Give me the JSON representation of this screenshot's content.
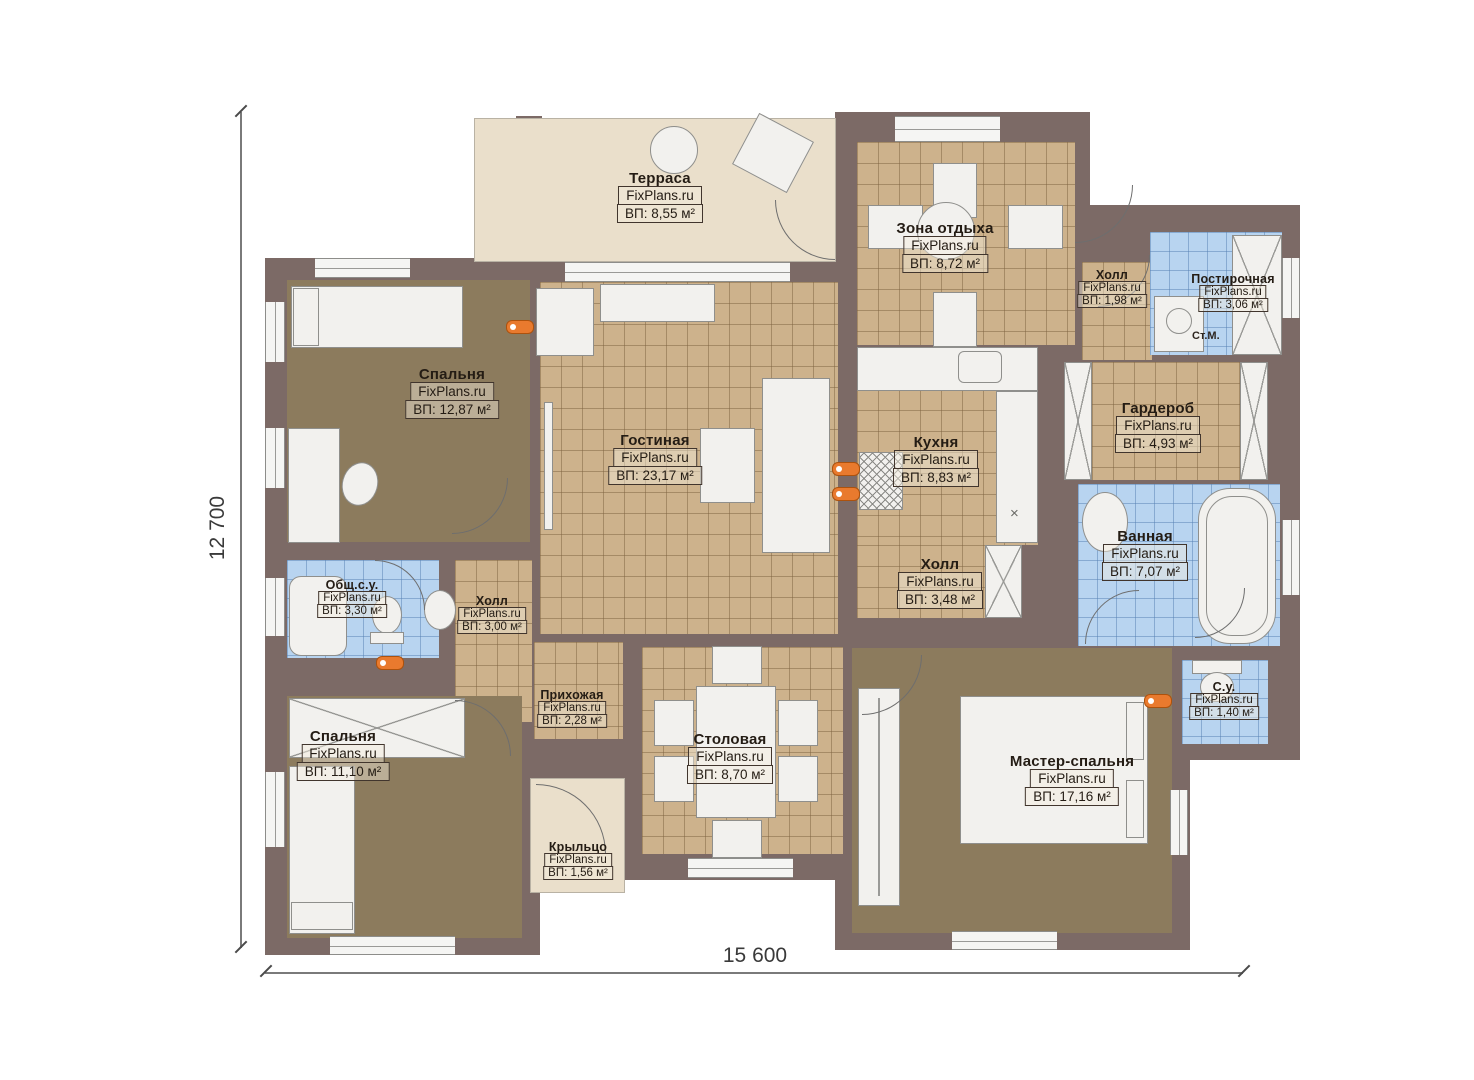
{
  "watermark": "FixPlans.ru",
  "dimensions": {
    "height_label": "12 700",
    "width_label": "15 600"
  },
  "annotations": {
    "washing_machine": "Ст.М.",
    "counter_cross": "×"
  },
  "rooms": [
    {
      "name": "Терраса",
      "area": "ВП: 8,55 м²"
    },
    {
      "name": "Зона отдыха",
      "area": "ВП: 8,72 м²"
    },
    {
      "name": "Холл",
      "area": "ВП: 1,98 м²"
    },
    {
      "name": "Постирочная",
      "area": "ВП: 3,06 м²"
    },
    {
      "name": "Спальня",
      "area": "ВП: 12,87 м²"
    },
    {
      "name": "Гостиная",
      "area": "ВП: 23,17 м²"
    },
    {
      "name": "Кухня",
      "area": "ВП: 8,83 м²"
    },
    {
      "name": "Гардероб",
      "area": "ВП: 4,93 м²"
    },
    {
      "name": "Ванная",
      "area": "ВП: 7,07 м²"
    },
    {
      "name": "Общ.с.у.",
      "area": "ВП: 3,30 м²"
    },
    {
      "name": "Холл",
      "area": "ВП: 3,00 м²"
    },
    {
      "name": "Холл",
      "area": "ВП: 3,48 м²"
    },
    {
      "name": "Спальня",
      "area": "ВП: 11,10 м²"
    },
    {
      "name": "Прихожая",
      "area": "ВП: 2,28 м²"
    },
    {
      "name": "Столовая",
      "area": "ВП: 8,70 м²"
    },
    {
      "name": "Мастер-спальня",
      "area": "ВП: 17,16 м²"
    },
    {
      "name": "С.у.",
      "area": "ВП: 1,40 м²"
    },
    {
      "name": "Крыльцо",
      "area": "ВП: 1,56 м²"
    }
  ],
  "colors": {
    "wall": "#7c6a66",
    "tile_tan": "#cdb28c",
    "tile_blue": "#b8d4f0",
    "floor_brown": "#8c7b5d",
    "floor_beige": "#eadfcb",
    "radiator": "#e97a2e"
  }
}
